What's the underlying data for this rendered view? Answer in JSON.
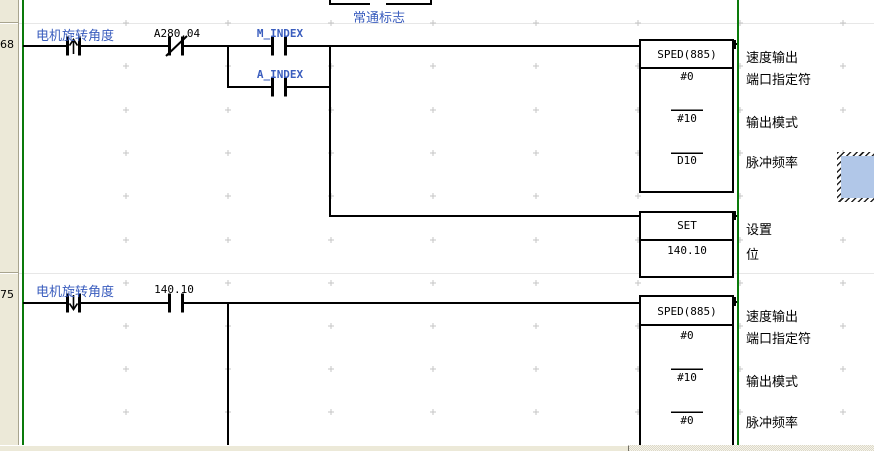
{
  "editor": {
    "colors": {
      "symbol_blue": "#3a5dbe",
      "bus_green": "#0a7a0a",
      "selection_fill": "#b1c7e8",
      "margin_bg": "#ece9d8"
    },
    "prev_rung": {
      "contact_label": "常通标志"
    },
    "rungs": [
      {
        "number": "68",
        "contacts": [
          {
            "label": "电机旋转角度",
            "type": "rising-edge"
          },
          {
            "label": "A280.04",
            "type": "normally-closed"
          },
          {
            "label": "M_INDEX",
            "type": "normally-open"
          },
          {
            "label": "A_INDEX",
            "type": "normally-open"
          }
        ],
        "instructions": [
          {
            "name": "SPED(885)",
            "operands": [
              "#0",
              "#10",
              "D10"
            ],
            "operand_comments": [
              "速度输出",
              "端口指定符",
              "输出模式",
              "脉冲频率"
            ]
          },
          {
            "name": "SET",
            "operands": [
              "140.10"
            ],
            "operand_comments": [
              "设置",
              "位"
            ]
          }
        ]
      },
      {
        "number": "75",
        "contacts": [
          {
            "label": "电机旋转角度",
            "type": "falling-edge"
          },
          {
            "label": "140.10",
            "type": "normally-open"
          }
        ],
        "instructions": [
          {
            "name": "SPED(885)",
            "operands": [
              "#0",
              "#10",
              "#0"
            ],
            "operand_comments": [
              "速度输出",
              "端口指定符",
              "输出模式",
              "脉冲频率"
            ]
          }
        ]
      }
    ]
  }
}
